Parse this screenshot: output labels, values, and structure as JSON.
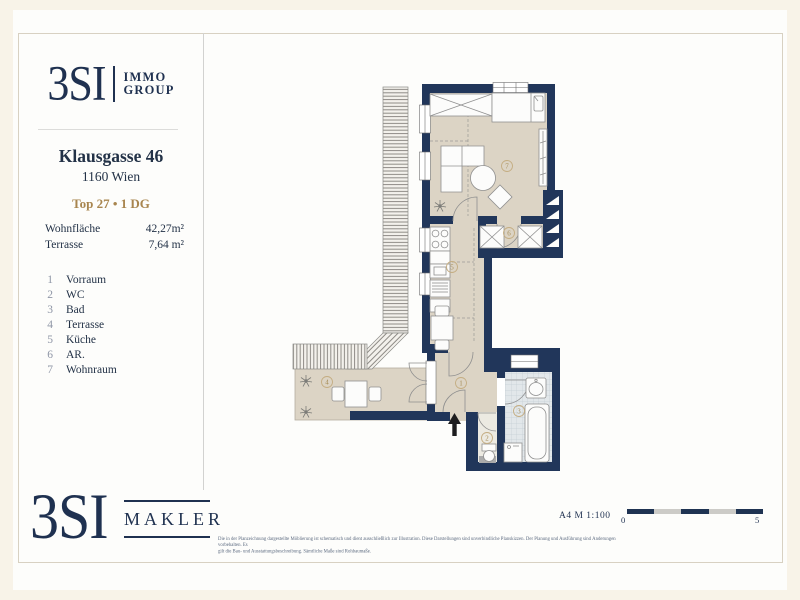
{
  "brand_top": {
    "name": "3SI",
    "line1": "IMMO",
    "line2": "GROUP"
  },
  "address": {
    "line1": "Klausgasse 46",
    "line2": "1160 Wien",
    "unit": "Top 27 • 1 DG"
  },
  "areas": [
    {
      "label": "Wohnfläche",
      "value": "42,27m²"
    },
    {
      "label": "Terrasse",
      "value": "7,64 m²"
    }
  ],
  "rooms": [
    {
      "number": "1",
      "name": "Vorraum"
    },
    {
      "number": "2",
      "name": "WC"
    },
    {
      "number": "3",
      "name": "Bad"
    },
    {
      "number": "4",
      "name": "Terrasse"
    },
    {
      "number": "5",
      "name": "Küche"
    },
    {
      "number": "6",
      "name": "AR."
    },
    {
      "number": "7",
      "name": "Wohnraum"
    }
  ],
  "footer": {
    "brand_name": "3SI",
    "brand_sub": "MAKLER",
    "disclaimer_line1": "Die in der Planzeichnung dargestellte Möblierung ist schematisch und dient ausschließlich zur Illustration. Diese Darstellungen sind unverbindliche Planskizzen. Der Planung und Ausführung sind Änderungen vorbehalten. Es",
    "disclaimer_line2": "gilt die Bau- und Ausstattungsbeschreibung. Sämtliche Maße sind Rohbaumaße.",
    "scale_label": "A4  M 1:100",
    "scale_zero": "0",
    "scale_five": "5"
  },
  "colors": {
    "navy": "#1F3150",
    "wall": "#21365A",
    "gold": "#A8854E",
    "floor_beige": "#DCD4C5",
    "tile": "#E2E7EA",
    "background_cream": "#F8F3E8"
  }
}
